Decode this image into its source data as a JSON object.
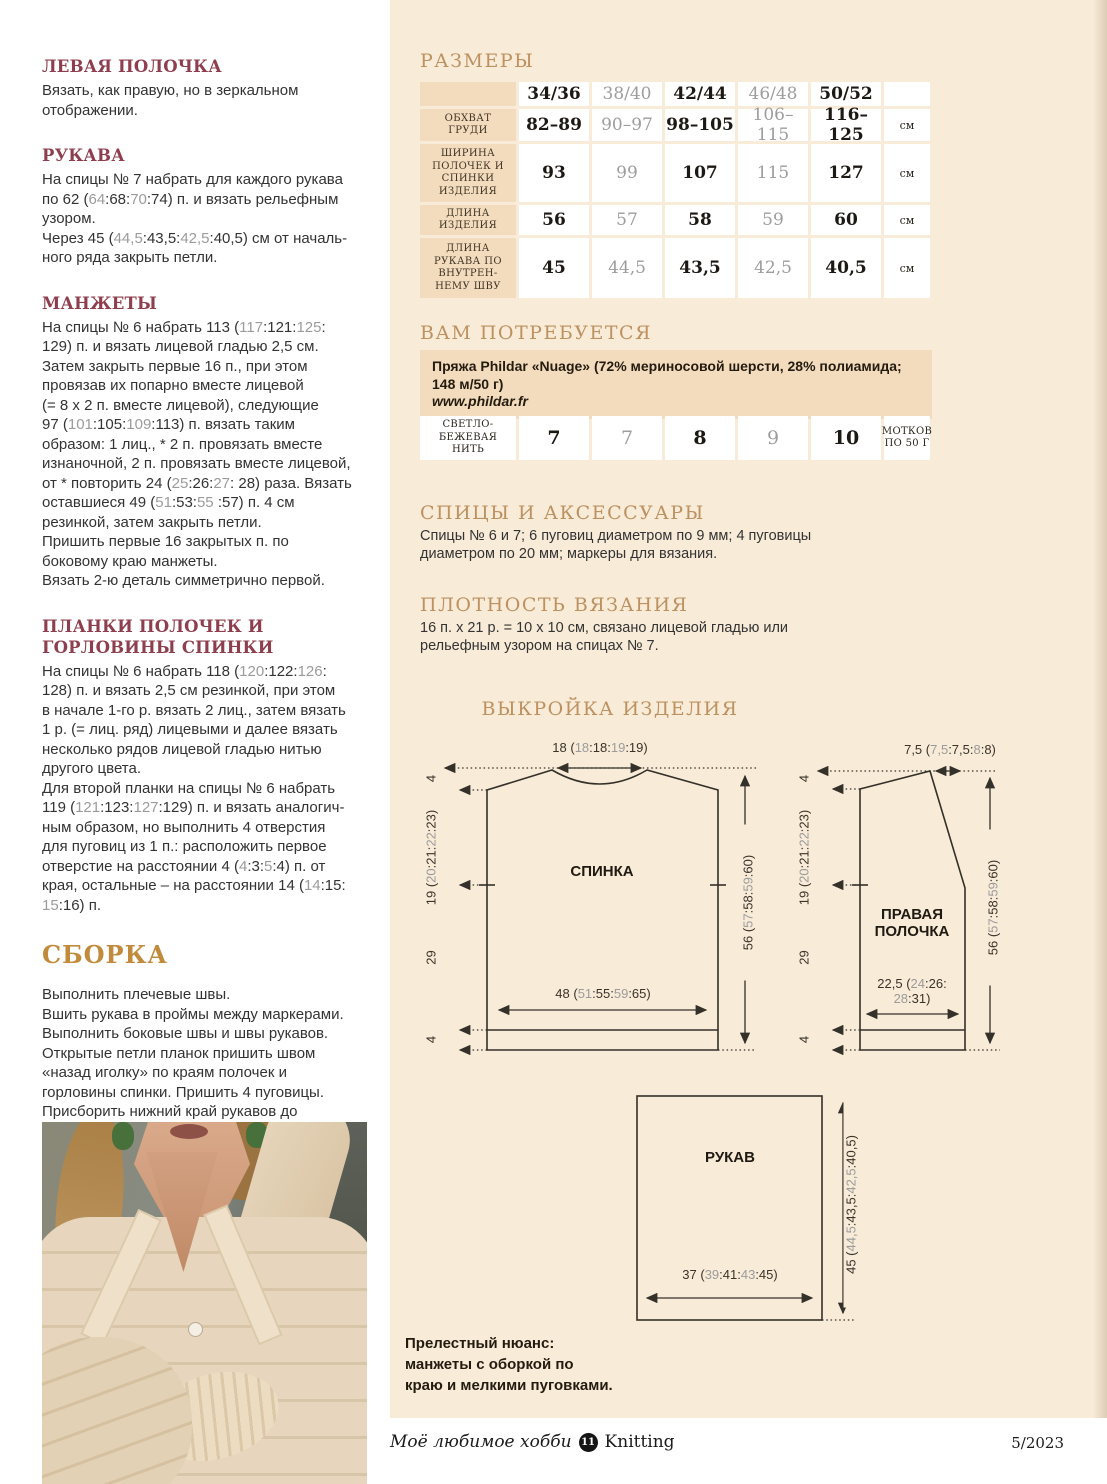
{
  "colors": {
    "page_cream": "#f8ebd8",
    "cell_beige": "#f3dcbd",
    "heading_gold": "#bd9160",
    "heading_maroon": "#8e3e4d",
    "assembly_gold": "#c28b3c",
    "muted_number_gray": "#9b9b9b"
  },
  "left_column": {
    "sections": [
      {
        "title": "ЛЕВАЯ ПОЛОЧКА",
        "paras": [
          "Вязать, как правую, но в зеркальном\nотображении."
        ]
      },
      {
        "title": "РУКАВА",
        "paras": [
          "На спицы № 7 набрать для каждого рукава\nпо 62 ([[64]]:68:[[70]]:74) п. и вязать рельефным\nузором.",
          "Через 45 ([[44,5]]:43,5:[[42,5]]:40,5) см от началь-\nного ряда закрыть петли."
        ]
      },
      {
        "title": "МАНЖЕТЫ",
        "paras": [
          "На спицы № 6 набрать 113 ([[117]]:121:[[125]]:\n129) п. и вязать лицевой гладью 2,5 см.\nЗатем закрыть первые 16 п., при этом\nпровязав их попарно вместе лицевой\n(= 8 х 2 п. вместе лицевой), следующие\n97 ([[101]]:105:[[109]]:113) п. вязать таким\nобразом: 1 лиц., * 2 п. провязать вместе\nизнаночной, 2 п. провязать вместе лицевой,\nот * повторить 24 ([[25]]:26:[[27]]: 28) раза. Вязать\nоставшиеся 49 ([[51]]:53:[[55]] :57) п. 4 см\nрезинкой, затем закрыть петли.\nПришить первые 16 закрытых п. по\nбоковому краю манжеты.\nВязать 2-ю деталь симметрично первой."
        ]
      },
      {
        "title": "ПЛАНКИ ПОЛОЧЕК И ГОРЛОВИНЫ СПИНКИ",
        "paras": [
          "На спицы № 6 набрать 118 ([[120]]:122:[[126]]:\n128) п. и вязать 2,5 см резинкой, при этом\nв начале 1-го р. вязать 2 лиц., затем вязать\n1 р. (= лиц. ряд) лицевыми и далее вязать\nнесколько рядов лицевой гладью нитью\nдругого цвета.\nДля второй планки на спицы № 6 набрать\n119 ([[121]]:123:[[127]]:129) п. и вязать аналогич-\nным образом, но выполнить 4 отверстия\nдля пуговиц из 1 п.: расположить первое\nотверстие на расстоянии 4 ([[4]]:3:[[5]]:4) п. от\nкрая, остальные – на расстоянии 14 ([[14]]:15:\n[[15]]:16) п."
        ]
      }
    ],
    "assembly": {
      "title": "СБОРКА",
      "para": "Выполнить плечевые швы.\nВшить рукава в проймы между маркерами.\nВыполнить боковые швы и швы рукавов.\nОткрытые петли планок пришить швом\n«назад иголку» по краям полочек и\nгорловины спинки. Пришить 4 пуговицы.\nПрисборить нижний край рукавов до\n24 ([[26]]:28:[[30]]:32) см, затем пришить манже-\nты, при этом в месте разреза наложить\nпервые 2 см поверх манжеты. Пришить\n3 маленьких пуговицы для имитации\nзастежки (см. фото). ⊕"
    }
  },
  "sizes": {
    "heading": "РАЗМЕРЫ",
    "col_headers": [
      "34/36",
      "38/40",
      "42/44",
      "46/48",
      "50/52"
    ],
    "rows": [
      {
        "label": "ОБХВАТ\nГРУДИ",
        "values": [
          "82–89",
          "90–97",
          "98–105",
          "106–115",
          "116–125"
        ],
        "unit": "см"
      },
      {
        "label": "ШИРИНА\nПОЛОЧЕК И\nСПИНКИ\nИЗДЕЛИЯ",
        "values": [
          "93",
          "99",
          "107",
          "115",
          "127"
        ],
        "unit": "см"
      },
      {
        "label": "ДЛИНА\nИЗДЕЛИЯ",
        "values": [
          "56",
          "57",
          "58",
          "59",
          "60"
        ],
        "unit": "см"
      },
      {
        "label": "ДЛИНА\nРУКАВА ПО\nВНУТРЕН-\nНЕМУ ШВУ",
        "values": [
          "45",
          "44,5",
          "43,5",
          "42,5",
          "40,5"
        ],
        "unit": "см"
      }
    ]
  },
  "materials": {
    "heading": "ВАМ ПОТРЕБУЕТСЯ",
    "yarn_info": "Пряжа Phildar «Nuage» (72% мериносовой шерсти, 28% полиамида;\n148 м/50 г)",
    "yarn_url": "www.phildar.fr",
    "yarn_row": {
      "label": "СВЕТЛО-\nБЕЖЕВАЯ\nНИТЬ",
      "values": [
        "7",
        "7",
        "8",
        "9",
        "10"
      ],
      "unit": "МОТКОВ\nПО 50 Г"
    }
  },
  "needles": {
    "heading": "СПИЦЫ И АКСЕССУАРЫ",
    "text": "Спицы № 6 и 7; 6 пуговиц диаметром по 9 мм; 4 пуговицы\nдиаметром по 20 мм; маркеры для вязания."
  },
  "gauge": {
    "heading": "ПЛОТНОСТЬ ВЯЗАНИЯ",
    "text": "16 п. х 21 р. = 10 х 10 см, связано лицевой гладью или\nрельефным узором на спицах № 7."
  },
  "pattern": {
    "heading": "ВЫКРОЙКА ИЗДЕЛИЯ",
    "back": {
      "name": "СПИНКА",
      "top_width": "18 ([[18]]:18:[[19]]:19)",
      "bottom_width": "48 ([[51]]:55:[[59]]:65)",
      "right_height": "56 ([[57]]:58:[[59]]:60)",
      "left_top": "4",
      "left_upper": "19 ([[20]]:21:[[22]]:23)",
      "left_mid": "29",
      "left_bottom": "4"
    },
    "front": {
      "name": "ПРАВАЯ\nПОЛОЧКА",
      "top_width": "7,5 ([[7,5]]:7,5:[[8]]:8)",
      "bottom_width": "22,5 ([[24]]:26:\n[[28]]:31)",
      "right_height": "56 ([[57]]:58:[[59]]:60)",
      "left_top": "4",
      "left_upper": "19 ([[20]]:21:[[22]]:23)",
      "left_mid": "29",
      "left_bottom": "4"
    },
    "sleeve": {
      "name": "РУКАВ",
      "bottom_width": "37 ([[39]]:41:[[43]]:45)",
      "right_height": "45 ([[44,5]]:43,5:[[42,5]]:40,5)"
    }
  },
  "note": "Прелестный нюанс:\nманжеты с оборкой по\nкраю и мелкими пуговками.",
  "footer": {
    "brand_italic": "Моё любимое хобби",
    "issue_badge": "11",
    "brand_serif": "Knitting",
    "issue": "5/2023"
  }
}
